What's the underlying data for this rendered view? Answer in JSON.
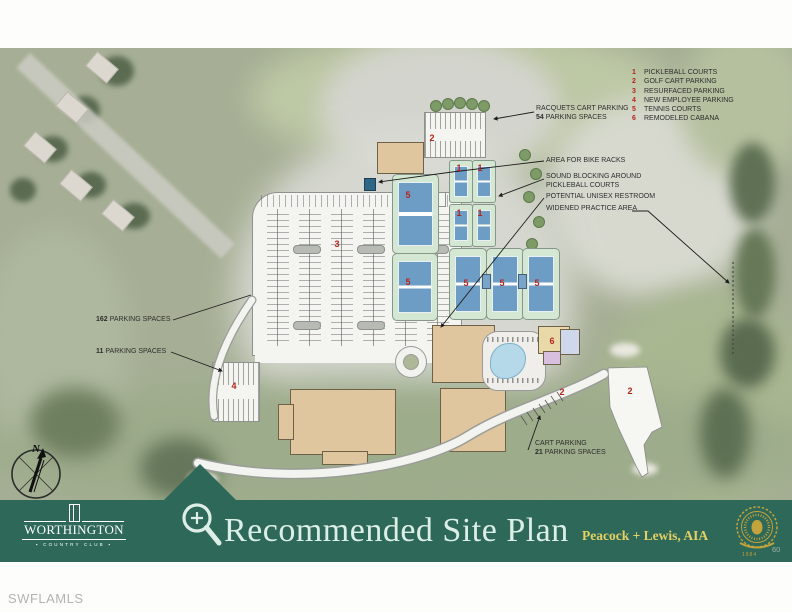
{
  "legend": {
    "items": [
      {
        "num": "1",
        "label": "PICKLEBALL COURTS"
      },
      {
        "num": "2",
        "label": "GOLF CART PARKING"
      },
      {
        "num": "3",
        "label": "RESURFACED PARKING"
      },
      {
        "num": "4",
        "label": "NEW EMPLOYEE PARKING"
      },
      {
        "num": "5",
        "label": "TENNIS COURTS"
      },
      {
        "num": "6",
        "label": "REMODELED CABANA"
      }
    ]
  },
  "labels": {
    "racquets": {
      "line1": "RACQUETS CART PARKING",
      "count": "54",
      "rest": "PARKING SPACES"
    },
    "bike_racks": "AREA FOR BIKE RACKS",
    "sound_blocking": {
      "line1": "SOUND BLOCKING AROUND",
      "line2": "PICKLEBALL COURTS"
    },
    "restroom": "POTENTIAL UNISEX RESTROOM",
    "practice_area": "WIDENED PRACTICE AREA",
    "spaces_162": {
      "count": "162",
      "rest": "PARKING SPACES"
    },
    "spaces_11": {
      "count": "11",
      "rest": "PARKING SPACES"
    },
    "cart_parking": {
      "line1": "CART PARKING",
      "count": "21",
      "rest": "PARKING SPACES"
    }
  },
  "markers": {
    "racquets_cart": "2",
    "pickleball_1": "1",
    "pickleball_2": "1",
    "pickleball_3": "1",
    "pickleball_4": "1",
    "resurfaced_lot": "3",
    "tennis_1": "5",
    "tennis_2": "5",
    "tennis_3": "5",
    "tennis_4": "5",
    "tennis_5": "5",
    "cabana": "6",
    "cart_path": "2",
    "cart_staging": "2",
    "employee": "4"
  },
  "compass": {
    "north": "N"
  },
  "banner": {
    "club_name": "WORTHINGTON",
    "club_divider": "▪",
    "club_subtitle": "COUNTRY CLUB",
    "title": "Recommended Site Plan",
    "credit": "Peacock + Lewis, AIA",
    "seal_year": "1984",
    "page_number": "60"
  },
  "watermark": "SWFLAMLS",
  "colors": {
    "banner_green": "#2d6858",
    "marker_red": "#b3261e",
    "credit_gold": "#e5d163",
    "court_blue": "#6d9dc4",
    "building_tan": "#e0c69e"
  }
}
